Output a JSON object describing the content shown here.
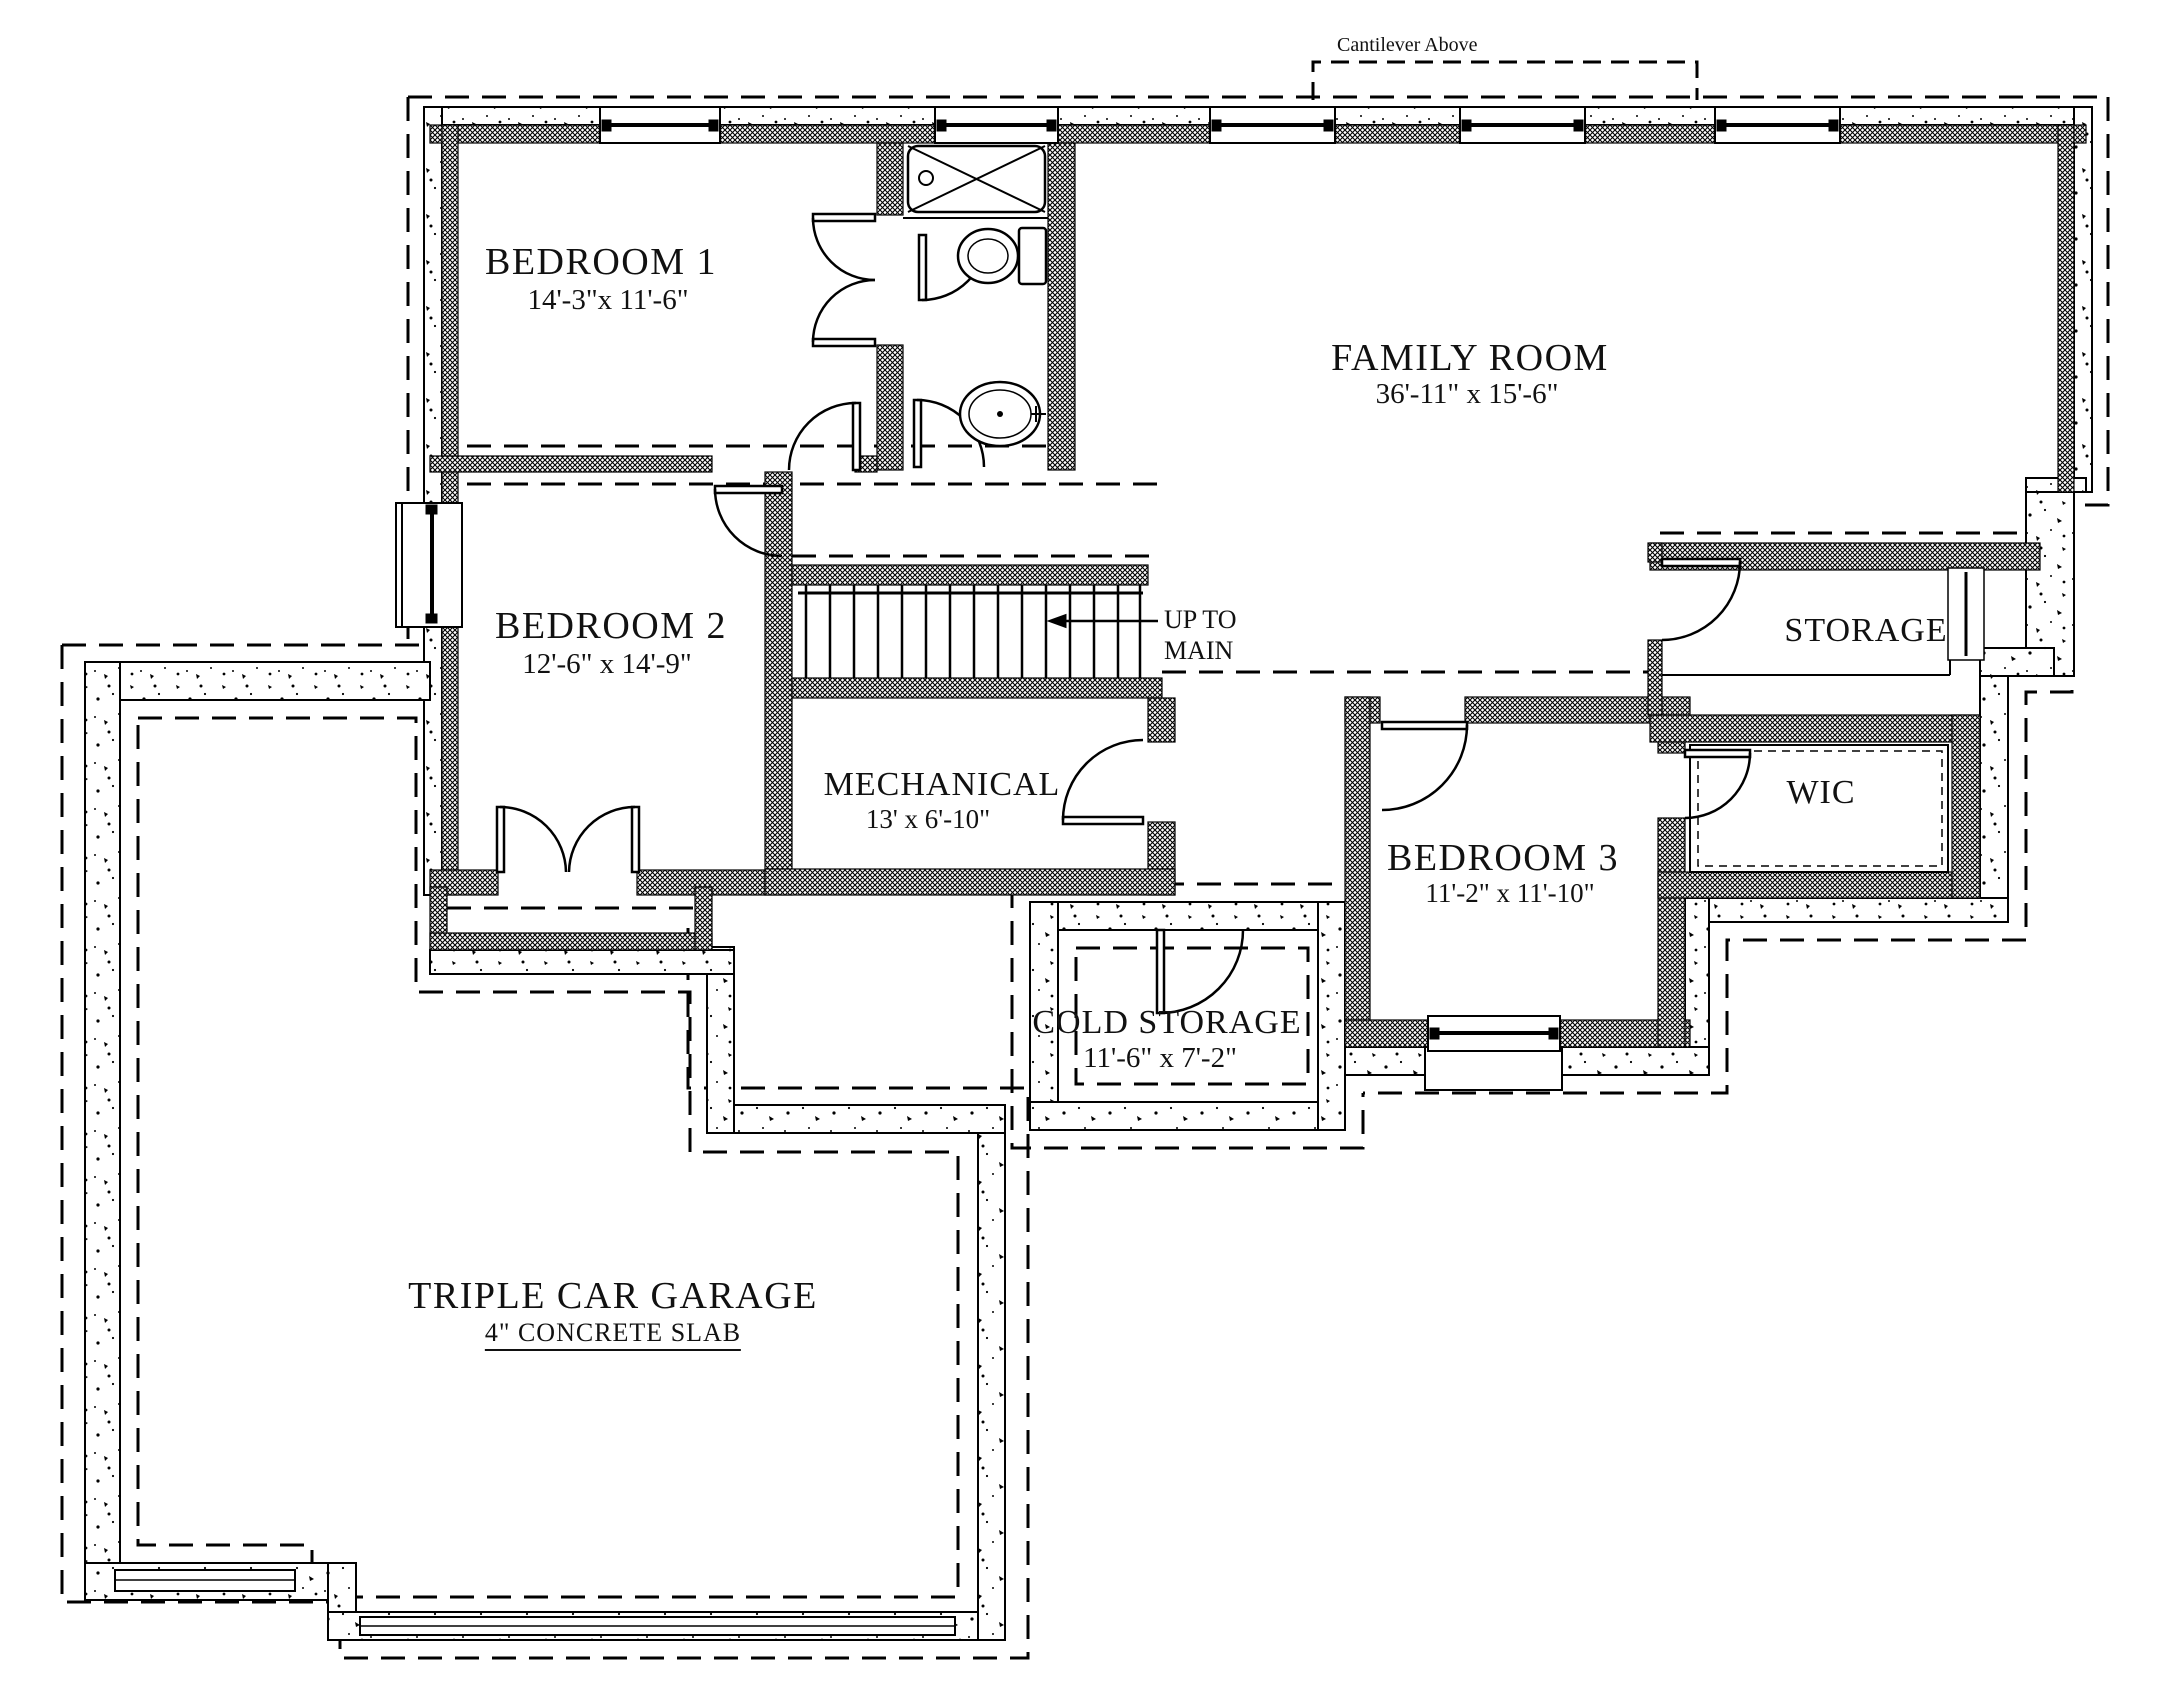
{
  "drawing_labels": {
    "cantilever": "Cantilever Above",
    "up_to_line1": "UP TO",
    "up_to_line2": "MAIN"
  },
  "rooms": {
    "bedroom1": {
      "name": "BEDROOM 1",
      "dims": "14'-3\"x 11'-6\""
    },
    "family_room": {
      "name": "FAMILY ROOM",
      "dims": "36'-11\" x 15'-6\""
    },
    "bedroom2": {
      "name": "BEDROOM 2",
      "dims": "12'-6\" x 14'-9\""
    },
    "storage": {
      "name": "STORAGE"
    },
    "mechanical": {
      "name": "MECHANICAL",
      "dims": "13' x 6'-10\""
    },
    "wic": {
      "name": "WIC"
    },
    "bedroom3": {
      "name": "BEDROOM 3",
      "dims": "11'-2\" x 11'-10\""
    },
    "cold_storage": {
      "name": "COLD STORAGE",
      "dims": "11'-6\" x 7'-2\""
    },
    "garage": {
      "name": "TRIPLE CAR GARAGE",
      "note": "4\" CONCRETE SLAB"
    }
  },
  "colors": {
    "ink": "#111111",
    "paper": "#ffffff"
  }
}
